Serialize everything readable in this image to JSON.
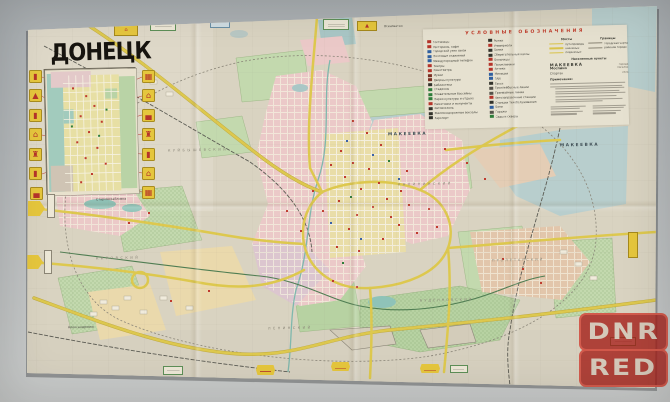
{
  "photo": {
    "surface_top": "#a9aeb1",
    "surface_bottom": "#c9cbca",
    "paper": "#d9d3c1"
  },
  "map": {
    "title": "ДОНЕЦК",
    "legend": {
      "title": "УСЛОВНЫЕ ОБОЗНАЧЕНИЯ",
      "col1": [
        {
          "label": "Гостиницы",
          "color": "#b5342a"
        },
        {
          "label": "Рестораны, кафе",
          "color": "#b5342a"
        },
        {
          "label": "Городской узел связи",
          "color": "#2f5fa0"
        },
        {
          "label": "Почтовые отделения",
          "color": "#2f5fa0"
        },
        {
          "label": "Междугородный телефон",
          "color": "#2f5fa0"
        },
        {
          "label": "Театры",
          "color": "#b5342a"
        },
        {
          "label": "Кинотеатры",
          "color": "#b5342a"
        },
        {
          "label": "Музеи",
          "color": "#7a2f23"
        },
        {
          "label": "Дворцы культуры",
          "color": "#7a2f23"
        },
        {
          "label": "Библиотеки",
          "color": "#33332c"
        },
        {
          "label": "Стадионы",
          "color": "#2e7d3a"
        },
        {
          "label": "Плавательные бассейны",
          "color": "#2e7d3a"
        },
        {
          "label": "Парки культуры и отдыха",
          "color": "#2e7d3a"
        },
        {
          "label": "Памятники и монументы",
          "color": "#b5342a"
        },
        {
          "label": "Автовокзалы",
          "color": "#33332c"
        },
        {
          "label": "Железнодорожные вокзалы",
          "color": "#33332c"
        },
        {
          "label": "Аэропорт",
          "color": "#33332c"
        }
      ],
      "col2": [
        {
          "label": "Рынки",
          "color": "#33332c"
        },
        {
          "label": "Универмаги",
          "color": "#b5342a"
        },
        {
          "label": "Банки",
          "color": "#33332c"
        },
        {
          "label": "Сберегательные кассы",
          "color": "#33332c"
        },
        {
          "label": "Больницы",
          "color": "#b5342a"
        },
        {
          "label": "Поликлиники",
          "color": "#b5342a"
        },
        {
          "label": "Аптеки",
          "color": "#b5342a"
        },
        {
          "label": "Милиция",
          "color": "#2f5fa0"
        },
        {
          "label": "ГАИ",
          "color": "#2f5fa0"
        },
        {
          "label": "Такси",
          "color": "#33332c"
        },
        {
          "label": "Троллейбусные линии",
          "color": "#55524a"
        },
        {
          "label": "Трамвайные линии",
          "color": "#55524a"
        },
        {
          "label": "Автозаправочные станции",
          "color": "#b5342a"
        },
        {
          "label": "Станции техобслуживания",
          "color": "#33332c"
        },
        {
          "label": "Бани",
          "color": "#2f5fa0"
        },
        {
          "label": "Гаражи",
          "color": "#55524a"
        },
        {
          "label": "Сады и скверы",
          "color": "#2e7d3a"
        }
      ],
      "right": {
        "hdr1": "Мосты",
        "hdr2": "Границы",
        "road_samples": [
          {
            "label": "путепроводы"
          },
          {
            "label": "наземные"
          },
          {
            "label": "подземные"
          }
        ],
        "border_samples": [
          {
            "label": "городская черта"
          },
          {
            "label": "районов города"
          }
        ],
        "settlements_hdr": "Населенные пункты",
        "settlements": [
          {
            "name": "МАКЕЕВКА",
            "desc": "города",
            "cls": "sname1"
          },
          {
            "name": "Моспино",
            "desc": "поселки",
            "cls": "sname2"
          },
          {
            "name": "Спартак",
            "desc": "села",
            "cls": "sname3"
          }
        ],
        "note_hdr": "Примечание:"
      }
    },
    "place_labels": [
      {
        "text": "МАКЕЕВКА",
        "css": {
          "left": "388px",
          "top": "131px",
          "fontSize": "4.2px",
          "letterSpacing": "1.6px",
          "fontWeight": "700",
          "color": "#3f4e55"
        }
      },
      {
        "text": "МАКЕЕВКА",
        "css": {
          "left": "560px",
          "top": "142px",
          "fontSize": "4.2px",
          "letterSpacing": "1.6px",
          "fontWeight": "700",
          "color": "#3f4e55"
        }
      },
      {
        "text": "Старомихайловка",
        "css": {
          "left": "96px",
          "top": "197px",
          "fontSize": "3.2px"
        }
      },
      {
        "text": "Александровка",
        "css": {
          "left": "68px",
          "top": "325px",
          "fontSize": "3.2px"
        }
      },
      {
        "text": "Ясиноватая",
        "css": {
          "left": "384px",
          "top": "24px",
          "fontSize": "3px"
        }
      },
      {
        "text": "КИРОВСКИЙ",
        "css": {
          "left": "96px",
          "top": "256px",
          "fontSize": "3.4px",
          "letterSpacing": "2.5px",
          "color": "#8a8578"
        }
      },
      {
        "text": "КУЙБЫШЕВСКИЙ",
        "css": {
          "left": "168px",
          "top": "148px",
          "fontSize": "3.4px",
          "letterSpacing": "2.5px",
          "color": "#8a8578"
        }
      },
      {
        "text": "ЛЕНИНСКИЙ",
        "css": {
          "left": "268px",
          "top": "326px",
          "fontSize": "3.4px",
          "letterSpacing": "2.5px",
          "color": "#8a8578"
        }
      },
      {
        "text": "КАЛИНИНСКИЙ",
        "css": {
          "left": "398px",
          "top": "182px",
          "fontSize": "3.4px",
          "letterSpacing": "2.5px",
          "color": "#8a8578"
        }
      },
      {
        "text": "ПРОЛЕТАРСКИЙ",
        "css": {
          "left": "492px",
          "top": "258px",
          "fontSize": "3.4px",
          "letterSpacing": "2px",
          "color": "#8a8578"
        }
      },
      {
        "text": "БУДЕННОВСКИЙ",
        "css": {
          "left": "420px",
          "top": "298px",
          "fontSize": "3.4px",
          "letterSpacing": "2px",
          "color": "#8a8578"
        }
      }
    ],
    "edge_markers": [
      {
        "n": "1",
        "x": 146,
        "y": 24
      },
      {
        "n": "2",
        "x": 197,
        "y": 22
      },
      {
        "n": "3",
        "x": 254,
        "y": 23
      },
      {
        "n": "4",
        "x": 318,
        "y": 21
      },
      {
        "n": "5",
        "x": 386,
        "y": 19
      },
      {
        "n": "6",
        "x": 457,
        "y": 16
      },
      {
        "n": "7",
        "x": 526,
        "y": 13
      },
      {
        "n": "8",
        "x": 600,
        "y": 11
      },
      {
        "n": "9",
        "x": 629,
        "y": 42
      },
      {
        "n": "10",
        "x": 631,
        "y": 116
      },
      {
        "n": "11",
        "x": 633,
        "y": 192
      },
      {
        "n": "12",
        "x": 629,
        "y": 258
      },
      {
        "n": "13",
        "x": 526,
        "y": 374
      },
      {
        "n": "14",
        "x": 458,
        "y": 372
      },
      {
        "n": "15",
        "x": 389,
        "y": 372
      },
      {
        "n": "16",
        "x": 320,
        "y": 370
      },
      {
        "n": "17",
        "x": 251,
        "y": 370
      },
      {
        "n": "18",
        "x": 197,
        "y": 368
      },
      {
        "n": "19",
        "x": 143,
        "y": 369
      },
      {
        "n": "20",
        "x": 91,
        "y": 368
      },
      {
        "n": "21",
        "x": 38,
        "y": 367
      },
      {
        "n": "22",
        "x": 18,
        "y": 349
      },
      {
        "n": "23",
        "x": 43,
        "y": 276
      },
      {
        "n": "24",
        "x": 44,
        "y": 224
      },
      {
        "n": "2",
        "x": 129,
        "y": 69
      }
    ],
    "landmark_badges": [
      {
        "glyph": "▮",
        "css": {
          "left": "29px",
          "top": "70px"
        }
      },
      {
        "glyph": "▲",
        "css": {
          "left": "29px",
          "top": "89px"
        }
      },
      {
        "glyph": "▮",
        "css": {
          "left": "29px",
          "top": "109px"
        }
      },
      {
        "glyph": "⌂",
        "css": {
          "left": "29px",
          "top": "128px"
        }
      },
      {
        "glyph": "♜",
        "css": {
          "left": "29px",
          "top": "148px"
        }
      },
      {
        "glyph": "▮",
        "css": {
          "left": "29px",
          "top": "167px"
        }
      },
      {
        "glyph": "▄",
        "css": {
          "left": "30px",
          "top": "187px"
        }
      },
      {
        "glyph": "▦",
        "css": {
          "left": "142px",
          "top": "70px"
        }
      },
      {
        "glyph": "⌂",
        "css": {
          "left": "142px",
          "top": "89px"
        }
      },
      {
        "glyph": "▄",
        "css": {
          "left": "142px",
          "top": "109px"
        }
      },
      {
        "glyph": "♜",
        "css": {
          "left": "142px",
          "top": "128px"
        }
      },
      {
        "glyph": "▮",
        "css": {
          "left": "142px",
          "top": "148px"
        }
      },
      {
        "glyph": "⌂",
        "css": {
          "left": "142px",
          "top": "167px"
        }
      },
      {
        "glyph": "▦",
        "css": {
          "left": "142px",
          "top": "186px"
        }
      }
    ],
    "edge_signs": [
      {
        "kind": "sign-yellow",
        "glyph": "⌂",
        "css": {
          "left": "114px",
          "top": "25px",
          "width": "24px",
          "height": "11px"
        }
      },
      {
        "kind": "sign-white",
        "css": {
          "left": "150px",
          "top": "22px",
          "width": "26px",
          "height": "9px"
        }
      },
      {
        "kind": "sign-blue",
        "css": {
          "left": "210px",
          "top": "20px",
          "width": "20px",
          "height": "8px"
        }
      },
      {
        "kind": "sign-white",
        "css": {
          "left": "323px",
          "top": "19px",
          "width": "26px",
          "height": "11px"
        }
      },
      {
        "kind": "sign-yellow",
        "glyph": "▲",
        "css": {
          "left": "357px",
          "top": "21px",
          "width": "20px",
          "height": "10px"
        }
      },
      {
        "kind": "sign-arrow",
        "css": {
          "left": "28px",
          "top": "201px",
          "width": "17px",
          "height": "15px"
        }
      },
      {
        "kind": "sign-whitev",
        "css": {
          "left": "47px",
          "top": "194px",
          "width": "8px",
          "height": "24px"
        }
      },
      {
        "kind": "sign-arrow",
        "css": {
          "left": "27px",
          "top": "255px",
          "width": "16px",
          "height": "14px"
        }
      },
      {
        "kind": "sign-whitev",
        "css": {
          "left": "44px",
          "top": "250px",
          "width": "8px",
          "height": "24px"
        }
      },
      {
        "kind": "sign-pennant",
        "css": {
          "left": "256px",
          "top": "365px",
          "width": "19px",
          "height": "10px"
        }
      },
      {
        "kind": "sign-pennant",
        "css": {
          "left": "331px",
          "top": "362px",
          "width": "19px",
          "height": "9px"
        }
      },
      {
        "kind": "sign-pennant",
        "css": {
          "left": "420px",
          "top": "364px",
          "width": "20px",
          "height": "9px"
        }
      },
      {
        "kind": "sign-white",
        "css": {
          "left": "163px",
          "top": "366px",
          "width": "20px",
          "height": "9px"
        }
      },
      {
        "kind": "sign-white",
        "css": {
          "left": "450px",
          "top": "365px",
          "width": "18px",
          "height": "8px"
        }
      },
      {
        "kind": "sign-white",
        "css": {
          "left": "610px",
          "top": "337px",
          "width": "26px",
          "height": "9px"
        }
      },
      {
        "kind": "sign-yellowv",
        "css": {
          "left": "628px",
          "top": "232px",
          "width": "10px",
          "height": "26px"
        }
      }
    ]
  },
  "watermark": {
    "line1": "DNR",
    "line2": "RED",
    "color": "#a41e18"
  }
}
